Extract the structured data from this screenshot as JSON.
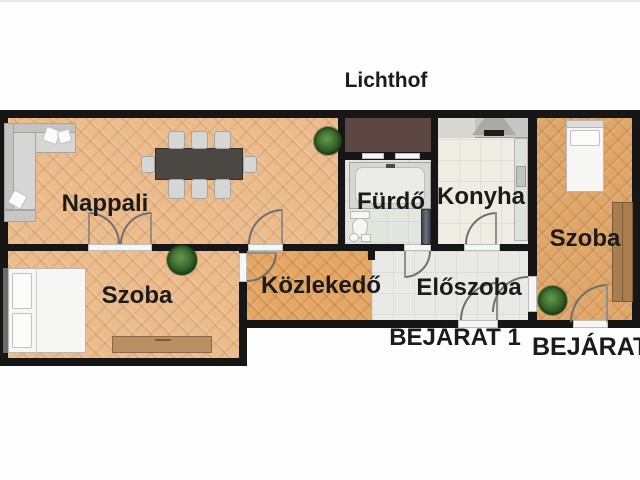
{
  "plan": {
    "title_label": "Lichthof",
    "rooms": {
      "nappali": {
        "label": "Nappali"
      },
      "furdo": {
        "label": "Fürdő"
      },
      "konyha": {
        "label": "Konyha"
      },
      "szoba_right": {
        "label": "Szoba"
      },
      "szoba_left": {
        "label": "Szoba"
      },
      "kozlekedo": {
        "label": "Közlekedő"
      },
      "eloszoba": {
        "label": "Előszoba"
      }
    },
    "entrances": {
      "bejarat1": "BEJÁRAT 1",
      "bejarat2": "BEJÁRAT 2"
    },
    "colors": {
      "wall": "#161616",
      "wood_floor": "#ecbc8c",
      "corridor_floor": "#e5a765",
      "right_room_floor": "#e0a76b",
      "bath_tile": "#e2e6de",
      "kitchen_tile": "#efede3",
      "hall_tile": "#e9e9e5",
      "light_shaft": "#5c4641",
      "background": "#fdfdfd",
      "label_text": "#1b1b1b"
    }
  }
}
